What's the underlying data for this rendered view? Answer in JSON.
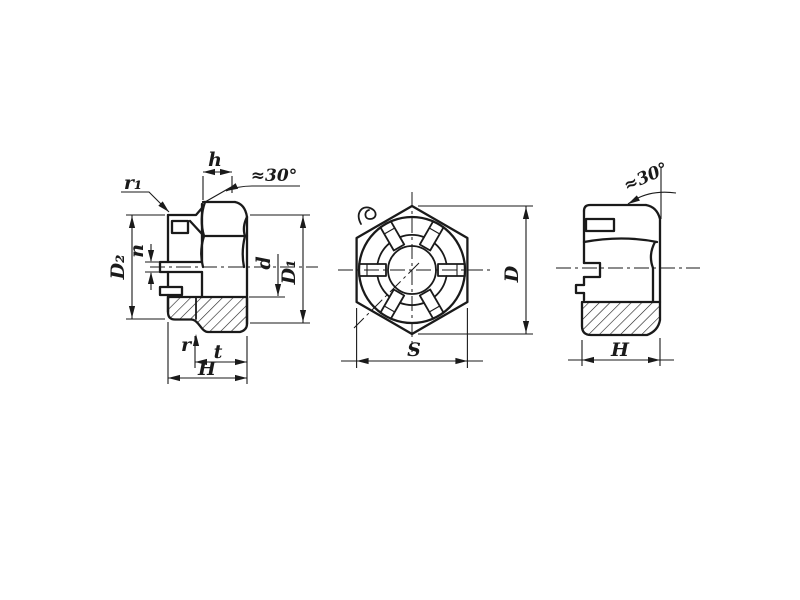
{
  "colors": {
    "ink": "#1a1a1a",
    "paper": "#ffffff"
  },
  "labels": {
    "left": {
      "h": "h",
      "angle": "≈30°",
      "r1": "r₁",
      "D2": "D₂",
      "n": "n",
      "d": "d",
      "D1": "D₁",
      "r": "r",
      "t": "t",
      "H": "H"
    },
    "front": {
      "S": "S",
      "D": "D"
    },
    "right": {
      "angle": "≈30°",
      "H": "H"
    }
  }
}
